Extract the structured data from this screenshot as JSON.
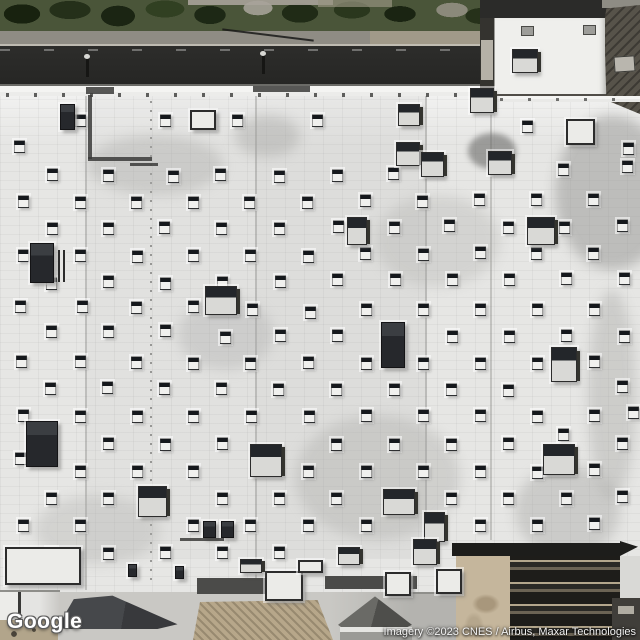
{
  "map": {
    "view": "satellite",
    "logo": "Google",
    "attribution": "Imagery ©2023 CNES / Airbus, Maxar Technologies"
  },
  "colors": {
    "roof": "#e6e6e4",
    "roof_bright": "#f4f4f2",
    "road": "#272725",
    "sidewalk": "#8f8c84",
    "trees_dark": "#1d2716",
    "annex_roof": "#efefec",
    "dark_building": "#57534a",
    "apron_concrete": "#c9c8c4",
    "plaza_tan": "#b7a78a",
    "canopy_dark": "#3f4144",
    "trellis_frame": "#1d1d1b",
    "trellis_tan": "#c5b69c",
    "vent_cap": "#15181c",
    "vent_body": "#f0f0ee",
    "logo_text": "#ffffff",
    "attribution_text": "#f2f2f2"
  },
  "scene": {
    "description": "Overhead satellite tile of a big-box store white rooftop with staggered vent grid, HVAC units, street with trees at top, annex building top-right, entrance canopies and garden trellis at bottom",
    "vents": [
      [
        75,
        114
      ],
      [
        160,
        114
      ],
      [
        232,
        114
      ],
      [
        312,
        114
      ],
      [
        522,
        120
      ],
      [
        623,
        142
      ],
      [
        14,
        140
      ],
      [
        47,
        168
      ],
      [
        103,
        169
      ],
      [
        168,
        170
      ],
      [
        215,
        168
      ],
      [
        274,
        170
      ],
      [
        332,
        169
      ],
      [
        388,
        167
      ],
      [
        558,
        163
      ],
      [
        622,
        160
      ],
      [
        18,
        195
      ],
      [
        75,
        196
      ],
      [
        131,
        196
      ],
      [
        188,
        196
      ],
      [
        244,
        196
      ],
      [
        302,
        196
      ],
      [
        360,
        194
      ],
      [
        417,
        195
      ],
      [
        474,
        193
      ],
      [
        531,
        193
      ],
      [
        588,
        193
      ],
      [
        47,
        222
      ],
      [
        103,
        222
      ],
      [
        159,
        221
      ],
      [
        216,
        222
      ],
      [
        274,
        222
      ],
      [
        333,
        220
      ],
      [
        389,
        221
      ],
      [
        444,
        219
      ],
      [
        503,
        221
      ],
      [
        559,
        221
      ],
      [
        617,
        219
      ],
      [
        18,
        249
      ],
      [
        75,
        249
      ],
      [
        132,
        250
      ],
      [
        188,
        249
      ],
      [
        245,
        249
      ],
      [
        303,
        250
      ],
      [
        360,
        247
      ],
      [
        418,
        248
      ],
      [
        475,
        246
      ],
      [
        531,
        247
      ],
      [
        588,
        247
      ],
      [
        46,
        277
      ],
      [
        103,
        275
      ],
      [
        160,
        277
      ],
      [
        217,
        276
      ],
      [
        275,
        275
      ],
      [
        332,
        273
      ],
      [
        390,
        273
      ],
      [
        447,
        273
      ],
      [
        504,
        273
      ],
      [
        561,
        272
      ],
      [
        619,
        272
      ],
      [
        15,
        300
      ],
      [
        77,
        300
      ],
      [
        131,
        301
      ],
      [
        188,
        300
      ],
      [
        247,
        303
      ],
      [
        305,
        306
      ],
      [
        361,
        303
      ],
      [
        418,
        303
      ],
      [
        475,
        303
      ],
      [
        532,
        303
      ],
      [
        589,
        303
      ],
      [
        46,
        325
      ],
      [
        103,
        325
      ],
      [
        160,
        324
      ],
      [
        220,
        331
      ],
      [
        275,
        329
      ],
      [
        332,
        329
      ],
      [
        447,
        330
      ],
      [
        504,
        330
      ],
      [
        561,
        329
      ],
      [
        619,
        330
      ],
      [
        16,
        355
      ],
      [
        75,
        355
      ],
      [
        131,
        356
      ],
      [
        188,
        357
      ],
      [
        245,
        357
      ],
      [
        303,
        356
      ],
      [
        361,
        357
      ],
      [
        418,
        357
      ],
      [
        475,
        357
      ],
      [
        532,
        357
      ],
      [
        589,
        355
      ],
      [
        45,
        382
      ],
      [
        102,
        381
      ],
      [
        159,
        382
      ],
      [
        216,
        382
      ],
      [
        273,
        383
      ],
      [
        331,
        383
      ],
      [
        389,
        383
      ],
      [
        446,
        383
      ],
      [
        503,
        384
      ],
      [
        617,
        380
      ],
      [
        18,
        409
      ],
      [
        75,
        410
      ],
      [
        132,
        410
      ],
      [
        188,
        410
      ],
      [
        246,
        410
      ],
      [
        304,
        410
      ],
      [
        361,
        409
      ],
      [
        418,
        409
      ],
      [
        475,
        409
      ],
      [
        532,
        410
      ],
      [
        589,
        409
      ],
      [
        628,
        406
      ],
      [
        103,
        437
      ],
      [
        160,
        438
      ],
      [
        217,
        437
      ],
      [
        331,
        438
      ],
      [
        389,
        438
      ],
      [
        446,
        438
      ],
      [
        503,
        437
      ],
      [
        558,
        428
      ],
      [
        617,
        437
      ],
      [
        15,
        452
      ],
      [
        75,
        465
      ],
      [
        132,
        465
      ],
      [
        188,
        465
      ],
      [
        303,
        465
      ],
      [
        361,
        465
      ],
      [
        418,
        465
      ],
      [
        475,
        465
      ],
      [
        532,
        466
      ],
      [
        589,
        463
      ],
      [
        46,
        492
      ],
      [
        103,
        492
      ],
      [
        217,
        492
      ],
      [
        274,
        492
      ],
      [
        331,
        492
      ],
      [
        446,
        492
      ],
      [
        503,
        492
      ],
      [
        561,
        492
      ],
      [
        617,
        490
      ],
      [
        18,
        519
      ],
      [
        75,
        519
      ],
      [
        188,
        519
      ],
      [
        245,
        519
      ],
      [
        303,
        519
      ],
      [
        361,
        519
      ],
      [
        475,
        519
      ],
      [
        532,
        519
      ],
      [
        589,
        517
      ],
      [
        46,
        547
      ],
      [
        103,
        547
      ],
      [
        160,
        546
      ],
      [
        217,
        546
      ],
      [
        274,
        546
      ]
    ],
    "units": [
      [
        60,
        104,
        15,
        26,
        "dark"
      ],
      [
        190,
        110,
        26,
        20,
        "frame"
      ],
      [
        470,
        88,
        24,
        25,
        "cap"
      ],
      [
        398,
        104,
        22,
        22,
        "cap"
      ],
      [
        396,
        142,
        24,
        24,
        "cap"
      ],
      [
        421,
        152,
        23,
        25,
        "cap"
      ],
      [
        488,
        151,
        24,
        24,
        "cap"
      ],
      [
        566,
        119,
        29,
        26,
        "frame"
      ],
      [
        347,
        217,
        20,
        28,
        "cap"
      ],
      [
        527,
        217,
        28,
        28,
        "cap"
      ],
      [
        30,
        243,
        24,
        40,
        "dark"
      ],
      [
        58,
        250,
        8,
        32,
        "stripes"
      ],
      [
        205,
        286,
        32,
        29,
        "cap"
      ],
      [
        381,
        322,
        24,
        46,
        "dark"
      ],
      [
        551,
        347,
        26,
        35,
        "cap"
      ],
      [
        26,
        421,
        32,
        46,
        "dark"
      ],
      [
        250,
        444,
        32,
        33,
        "cap"
      ],
      [
        138,
        486,
        29,
        31,
        "cap"
      ],
      [
        543,
        444,
        32,
        31,
        "cap"
      ],
      [
        383,
        489,
        32,
        26,
        "cap"
      ],
      [
        424,
        512,
        21,
        30,
        "cap"
      ],
      [
        413,
        539,
        24,
        26,
        "cap"
      ],
      [
        338,
        547,
        22,
        18,
        "cap"
      ],
      [
        512,
        49,
        26,
        24,
        "cap"
      ],
      [
        203,
        521,
        13,
        17,
        "dark"
      ],
      [
        221,
        521,
        13,
        17,
        "dark"
      ],
      [
        128,
        564,
        9,
        13,
        "dark"
      ],
      [
        175,
        566,
        9,
        13,
        "dark"
      ],
      [
        5,
        547,
        76,
        38,
        "frame"
      ],
      [
        265,
        571,
        38,
        30,
        "frame"
      ],
      [
        385,
        572,
        26,
        24,
        "frame"
      ],
      [
        436,
        569,
        26,
        25,
        "frame"
      ],
      [
        240,
        559,
        22,
        14,
        "cap"
      ],
      [
        298,
        560,
        25,
        13,
        "frame"
      ]
    ],
    "pipes": [
      [
        86,
        87,
        28,
        7
      ],
      [
        253,
        86,
        57,
        6
      ],
      [
        88,
        95,
        4,
        64
      ],
      [
        88,
        157,
        64,
        4
      ],
      [
        130,
        163,
        28,
        3
      ],
      [
        180,
        538,
        44,
        3
      ],
      [
        18,
        592,
        3,
        28
      ]
    ]
  }
}
